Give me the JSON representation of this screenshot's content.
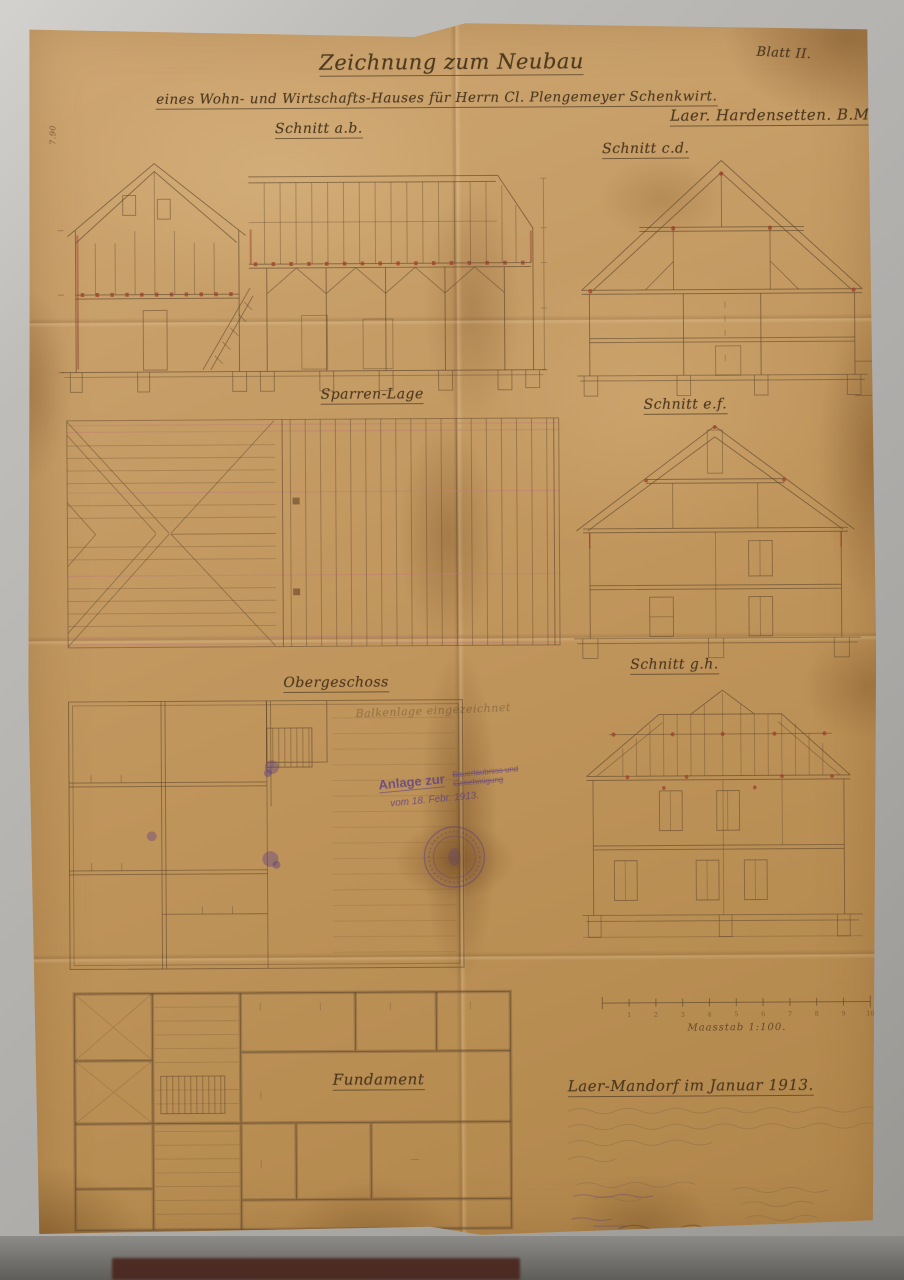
{
  "meta": {
    "sheet": "Blatt II."
  },
  "header": {
    "title": "Zeichnung zum Neubau",
    "subtitle": "eines Wohn- und Wirtschafts-Hauses für Herrn Cl. Plengemeyer Schenkwirt.",
    "location": "Laer. Hardensetten. B.M."
  },
  "labels": {
    "schnitt_ab": "Schnitt a.b.",
    "schnitt_cd": "Schnitt c.d.",
    "sparren_lage": "Sparren-Lage",
    "schnitt_ef": "Schnitt e.f.",
    "obergeschoss": "Obergeschoss",
    "obergeschoss_note": "Balkenlage eingezeichnet",
    "schnitt_gh": "Schnitt g.h.",
    "fundament": "Fundament",
    "left_dimension": "7.90"
  },
  "stamp": {
    "word1": "Anlage zur",
    "line2": "Bauerlaubniss und",
    "line3": "Genehmigung",
    "date": "vom 18. Febr. 1913."
  },
  "scale": {
    "label": "Maasstab 1:100.",
    "ticks": [
      "1",
      "2",
      "3",
      "4",
      "5",
      "6",
      "7",
      "8",
      "9",
      "10"
    ]
  },
  "footer": {
    "place_date": "Laer-Mandorf im Januar 1913."
  },
  "colors": {
    "paper": "#c49a61",
    "ink": "#4d3a24",
    "red_accent": "#9c3a28",
    "pink_line": "#c08274",
    "stamp_purple": "#5d3f85"
  }
}
